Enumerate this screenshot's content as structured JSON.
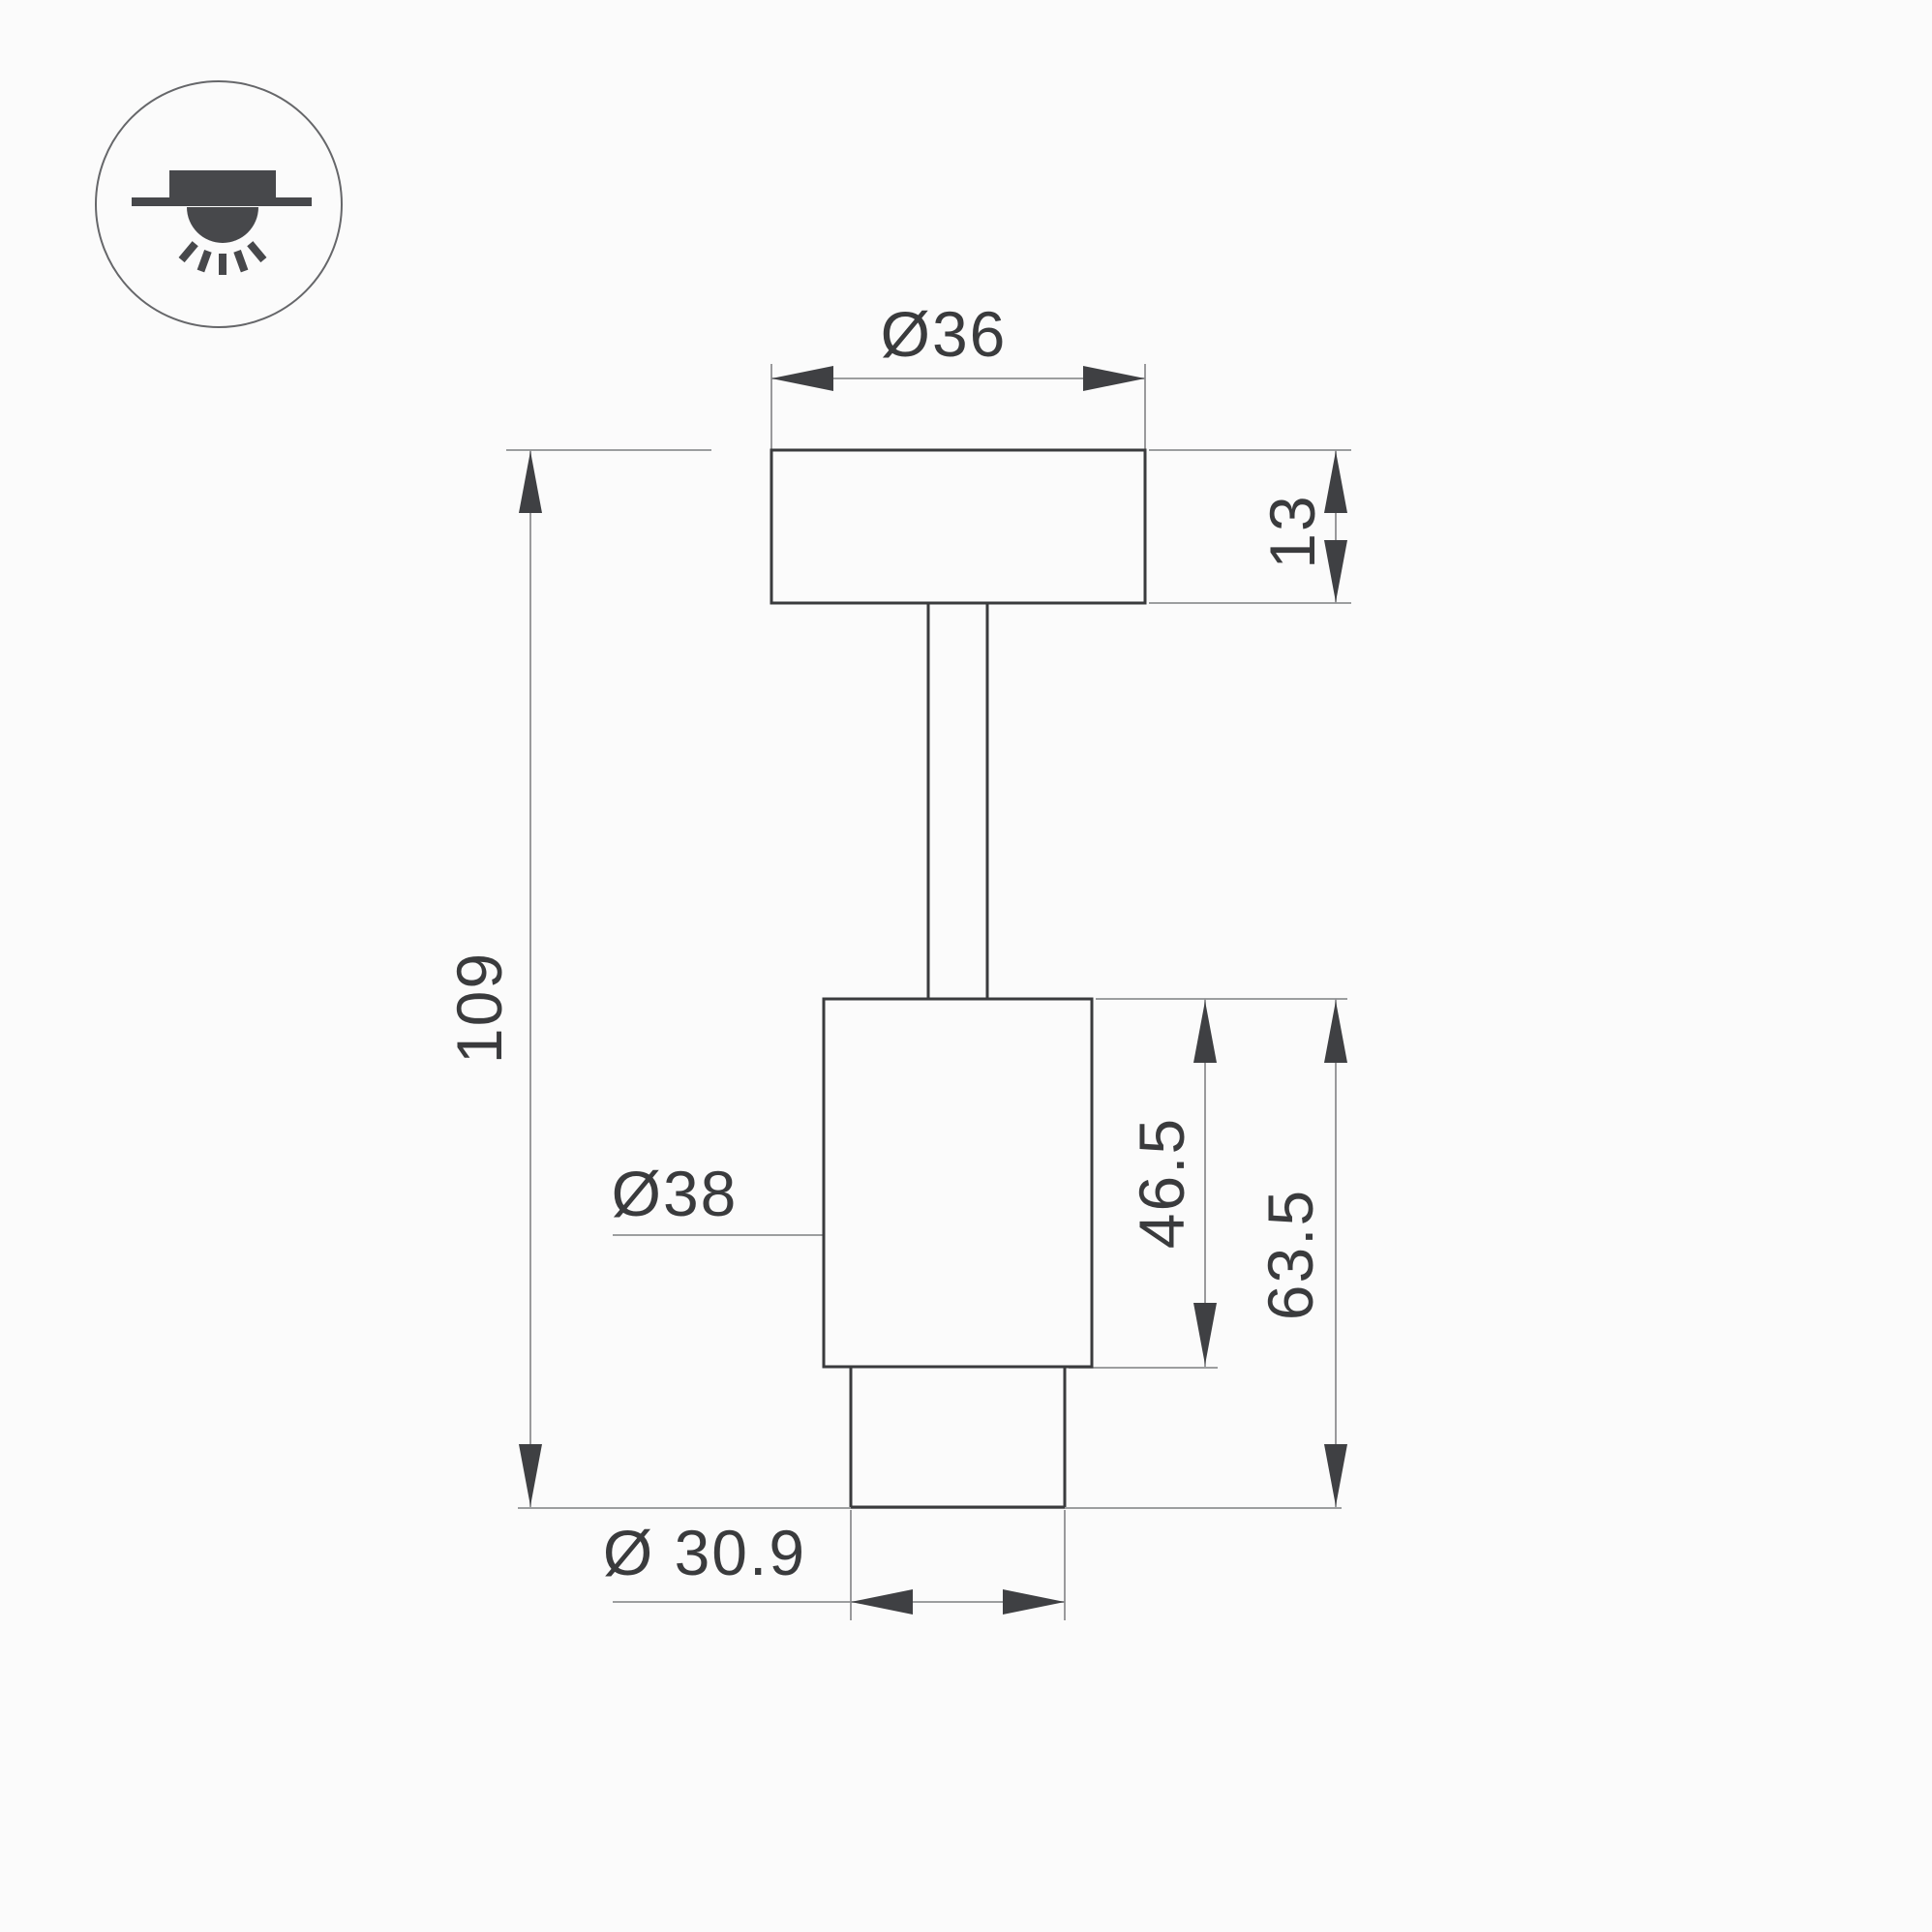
{
  "drawing": {
    "kind": "technical dimension drawing",
    "icon": "surface-mounted-ceiling-light-icon",
    "labels": {
      "top_diameter": "Ø36",
      "plate_thickness": "13",
      "overall_height": "109",
      "body_diameter": "Ø38",
      "body_height": "46.5",
      "lower_section_height": "63.5",
      "bottom_diameter": "Ø 30.9"
    },
    "colors": {
      "outline": "#3a3b3d",
      "dimension_lines": "#8f9092",
      "text": "#3a3b3d",
      "icon": "#47484b",
      "background": "#fbfbfb"
    }
  }
}
